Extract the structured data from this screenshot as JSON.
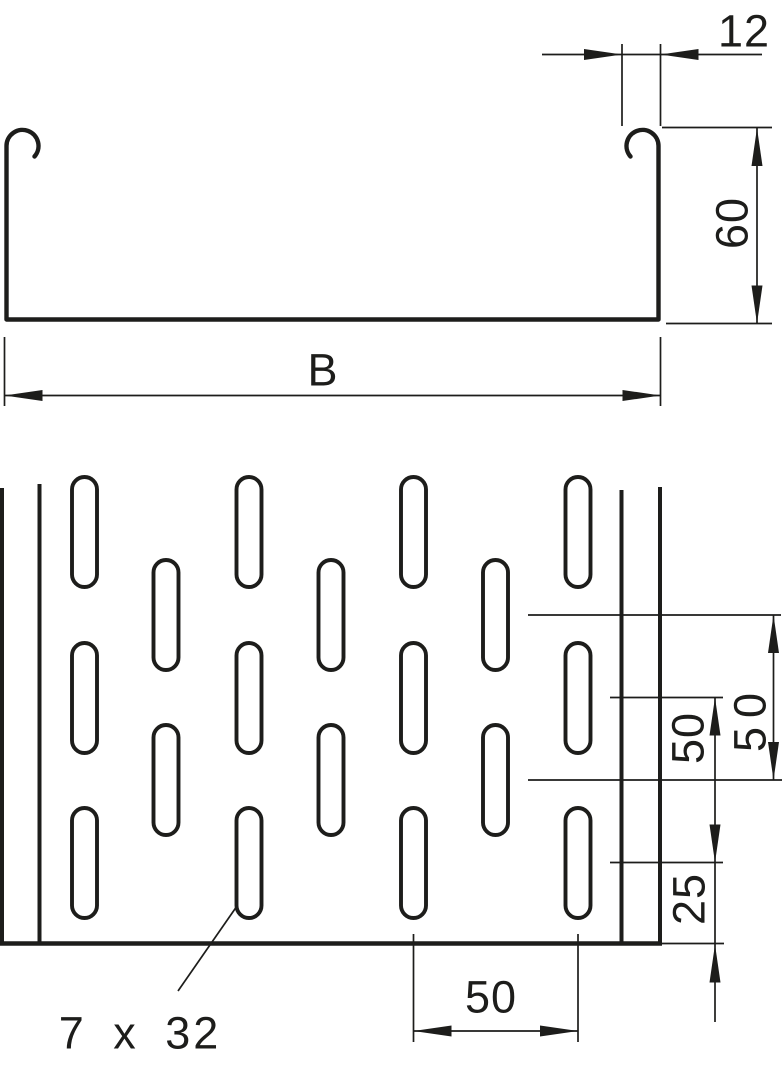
{
  "page": {
    "background": "#ffffff",
    "line_color": "#1d1d1b"
  },
  "section_view": {
    "dims": {
      "flange_width": "12",
      "height": "60",
      "width": "B"
    }
  },
  "plan_view": {
    "dims": {
      "offset_row_pitch": "50",
      "main_row_pitch": "50",
      "edge_distance": "25",
      "column_pitch": "50"
    },
    "slot_size": "7 x 32"
  }
}
